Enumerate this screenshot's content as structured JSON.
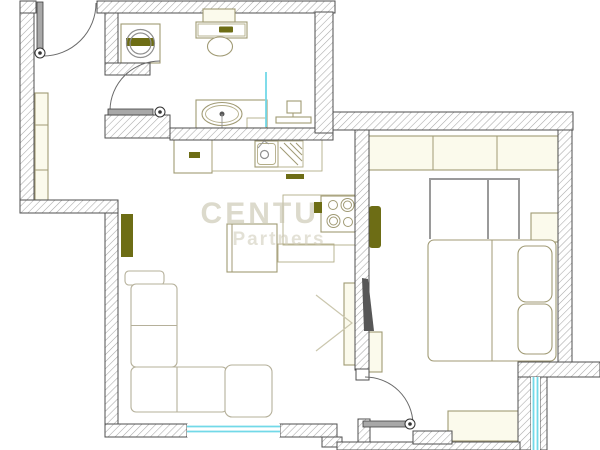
{
  "watermark": {
    "line1": "CENTURY",
    "line2": "Partners"
  },
  "canvas": {
    "width": 600,
    "height": 450,
    "background": "#ffffff"
  },
  "plan": {
    "wall_stroke": "#4f4f4f",
    "hatch_line": "#a8a8a8",
    "styles": {
      "tan": {
        "stroke": "#a09a74",
        "fill": "#ffffff",
        "sw": 1.1
      },
      "tanthin": {
        "stroke": "#b3ad88",
        "fill": "none",
        "sw": 0.9
      },
      "cream": {
        "stroke": "#a09a74",
        "fill": "#fbfaec",
        "sw": 1.1
      },
      "olive": {
        "stroke": "none",
        "fill": "#6d6d15",
        "sw": 0
      },
      "tanline": {
        "stroke": "#a09a74",
        "fill": "none",
        "sw": 1
      },
      "chevron": {
        "stroke": "#cbc7ae",
        "fill": "none",
        "sw": 1.2
      },
      "gray": {
        "stroke": "#8f8f8f",
        "fill": "none",
        "sw": 1.2
      },
      "gray2": {
        "stroke": "#9a9a9a",
        "fill": "none",
        "sw": 2
      },
      "grayline": {
        "stroke": "#999999",
        "fill": "none",
        "sw": 1
      },
      "sofa": {
        "stroke": "#b5b09a",
        "fill": "#ffffff",
        "sw": 1.1
      },
      "cyan": {
        "stroke": "#72d9e8",
        "fill": "none",
        "sw": 1.8
      },
      "dark": {
        "stroke": "none",
        "fill": "#575757",
        "sw": 0
      },
      "white": {
        "stroke": "#4f4f4f",
        "fill": "#ffffff",
        "sw": 1
      },
      "door": {
        "stroke": "#3e3e3e",
        "fill": "#a8a8a8",
        "sw": 0.8
      },
      "arc": {
        "stroke": "#6a6a6a",
        "fill": "none",
        "sw": 1
      }
    },
    "walls": [
      {
        "n": "wall-left-outer",
        "x": 20,
        "y": 1,
        "w": 14,
        "h": 205
      },
      {
        "n": "wall-top-left-corner",
        "x": 20,
        "y": 1,
        "w": 16,
        "h": 12
      },
      {
        "n": "wall-top-bathroom",
        "x": 97,
        "y": 1,
        "w": 238,
        "h": 12
      },
      {
        "n": "wall-hall-bath-divider",
        "x": 105,
        "y": 13,
        "w": 13,
        "h": 54
      },
      {
        "n": "wall-divider-foot",
        "x": 105,
        "y": 63,
        "w": 45,
        "h": 12
      },
      {
        "n": "wall-bath-south-left",
        "x": 105,
        "y": 115,
        "w": 65,
        "h": 23
      },
      {
        "n": "wall-bath-south-right",
        "x": 170,
        "y": 128,
        "w": 163,
        "h": 12
      },
      {
        "n": "wall-bath-east",
        "x": 315,
        "y": 12,
        "w": 18,
        "h": 121
      },
      {
        "n": "wall-bedroom-north",
        "x": 333,
        "y": 112,
        "w": 240,
        "h": 18
      },
      {
        "n": "wall-bedroom-west",
        "x": 355,
        "y": 130,
        "w": 14,
        "h": 240
      },
      {
        "n": "wall-bedroom-east",
        "x": 558,
        "y": 130,
        "w": 14,
        "h": 235
      },
      {
        "n": "wall-bedroom-se",
        "x": 518,
        "y": 362,
        "w": 82,
        "h": 15
      },
      {
        "n": "wall-balcony-left-strip",
        "x": 518,
        "y": 377,
        "w": 13,
        "h": 73
      },
      {
        "n": "wall-balcony-right-strip",
        "x": 540,
        "y": 377,
        "w": 7,
        "h": 73
      },
      {
        "n": "wall-jog-horizontal",
        "x": 20,
        "y": 200,
        "w": 98,
        "h": 13
      },
      {
        "n": "wall-living-west",
        "x": 105,
        "y": 213,
        "w": 13,
        "h": 224
      },
      {
        "n": "wall-living-south-a",
        "x": 105,
        "y": 424,
        "w": 82,
        "h": 13
      },
      {
        "n": "wall-living-south-b",
        "x": 280,
        "y": 424,
        "w": 57,
        "h": 13
      },
      {
        "n": "wall-jog-step",
        "x": 322,
        "y": 437,
        "w": 20,
        "h": 10
      },
      {
        "n": "wall-doorway-strip",
        "x": 358,
        "y": 419,
        "w": 12,
        "h": 31
      },
      {
        "n": "wall-bottom-band",
        "x": 337,
        "y": 442,
        "w": 183,
        "h": 8
      },
      {
        "n": "wall-bottom-right",
        "x": 413,
        "y": 431,
        "w": 39,
        "h": 13
      }
    ],
    "floor": [
      {
        "n": "hall-wardrobe",
        "k": "rect",
        "st": "cream",
        "x": 35,
        "y": 93,
        "w": 13,
        "h": 107
      },
      {
        "n": "hall-wardrobe-shelf",
        "k": "line",
        "st": "tanline",
        "x1": 35,
        "y1": 125,
        "x2": 48,
        "y2": 125
      },
      {
        "n": "hall-wardrobe-shelf",
        "k": "line",
        "st": "tanline",
        "x1": 35,
        "y1": 170,
        "x2": 48,
        "y2": 170
      },
      {
        "n": "washing-machine-body",
        "k": "rect",
        "st": "tan",
        "x": 121,
        "y": 24,
        "w": 39,
        "h": 39
      },
      {
        "n": "washing-machine-band",
        "k": "rect",
        "st": "olive",
        "x": 126,
        "y": 38,
        "w": 28,
        "h": 8
      },
      {
        "n": "washing-machine-drum",
        "k": "circle",
        "st": "gray",
        "cx": 140.5,
        "cy": 43.5,
        "r": 14
      },
      {
        "n": "washing-machine-drum-inner",
        "k": "circle",
        "st": "gray",
        "cx": 140.5,
        "cy": 43.5,
        "r": 10.5
      },
      {
        "n": "toilet-tank",
        "k": "rect",
        "st": "tan",
        "x": 196,
        "y": 22,
        "w": 51,
        "h": 16
      },
      {
        "n": "toilet-tank-inner",
        "k": "rect",
        "st": "tanthin",
        "x": 198,
        "y": 24,
        "w": 47,
        "h": 12
      },
      {
        "n": "toilet-flush-button",
        "k": "rect",
        "st": "olive",
        "x": 219,
        "y": 26.5,
        "w": 14,
        "h": 6,
        "rx": 1
      },
      {
        "n": "toilet-bowl",
        "k": "ellipse",
        "st": "tan",
        "cx": 220,
        "cy": 46.5,
        "rx": 12.5,
        "ry": 9.5
      },
      {
        "n": "bath-vanity",
        "k": "rect",
        "st": "tan",
        "x": 196,
        "y": 100,
        "w": 71,
        "h": 28
      },
      {
        "n": "bath-basin",
        "k": "ellipse",
        "st": "tan",
        "cx": 222,
        "cy": 114,
        "rx": 20,
        "ry": 11.5
      },
      {
        "n": "bath-basin-inner",
        "k": "ellipse",
        "st": "tanthin",
        "cx": 222,
        "cy": 114,
        "rx": 16.5,
        "ry": 8.5
      },
      {
        "n": "bath-faucet",
        "k": "circle",
        "st": "dark",
        "cx": 222,
        "cy": 114,
        "r": 2.5
      },
      {
        "n": "bath-faucet-stem",
        "k": "line",
        "st": "grayline",
        "x1": 222,
        "y1": 114,
        "x2": 222,
        "y2": 129
      },
      {
        "n": "bath-vanity-step",
        "k": "rect",
        "st": "tanthin",
        "x": 247,
        "y": 118,
        "w": 19,
        "h": 10
      },
      {
        "n": "towel-radiator-box",
        "k": "rect",
        "st": "tan",
        "x": 287,
        "y": 101,
        "w": 14,
        "h": 12
      },
      {
        "n": "towel-radiator-base",
        "k": "rect",
        "st": "tan",
        "x": 276,
        "y": 117,
        "w": 35,
        "h": 6
      },
      {
        "n": "towel-radiator-stem",
        "k": "line",
        "st": "tanline",
        "x1": 293,
        "y1": 113,
        "x2": 293,
        "y2": 117
      },
      {
        "n": "bath-partition",
        "k": "line",
        "st": "cyan",
        "x1": 266,
        "y1": 72,
        "x2": 266,
        "y2": 127
      },
      {
        "n": "fridge",
        "k": "rect",
        "st": "tan",
        "x": 174,
        "y": 137,
        "w": 38,
        "h": 36
      },
      {
        "n": "fridge-handle",
        "k": "rect",
        "st": "olive",
        "x": 189,
        "y": 152,
        "w": 11,
        "h": 6
      },
      {
        "n": "kitchen-counter",
        "k": "rect",
        "st": "tanthin",
        "x": 212,
        "y": 138,
        "w": 110,
        "h": 33
      },
      {
        "n": "kitchen-sink",
        "k": "rect",
        "st": "tan",
        "x": 255,
        "y": 141,
        "w": 23,
        "h": 26
      },
      {
        "n": "kitchen-sink-inner",
        "k": "rect",
        "st": "tanthin",
        "x": 257.5,
        "y": 143.5,
        "w": 18,
        "h": 21,
        "rx": 3
      },
      {
        "n": "kitchen-sink-drain",
        "k": "circle",
        "st": "gray",
        "cx": 264.5,
        "cy": 154.5,
        "r": 4
      },
      {
        "n": "kitchen-faucet",
        "k": "path",
        "st": "grayline",
        "d": "M258,148 L264,141 L269,144"
      },
      {
        "n": "kitchen-drainer",
        "k": "rect",
        "st": "tanthin",
        "x": 278,
        "y": 141,
        "w": 25,
        "h": 26
      },
      {
        "n": "kitchen-drainer-lines",
        "k": "path",
        "st": "tanline",
        "d": "M280,147 L298,165 M284,143 L302,161 M290,143 L302,155 M296,143 L302,149"
      },
      {
        "n": "kitchen-cabinet-handle",
        "k": "rect",
        "st": "olive",
        "x": 286,
        "y": 174,
        "w": 18,
        "h": 5
      },
      {
        "n": "stove-counter",
        "k": "rect",
        "st": "tanthin",
        "x": 283,
        "y": 195,
        "w": 73,
        "h": 50
      },
      {
        "n": "kitchen-table",
        "k": "rect",
        "st": "tan",
        "x": 227,
        "y": 224,
        "w": 50,
        "h": 48
      },
      {
        "n": "kitchen-table-edge",
        "k": "line",
        "st": "tanline",
        "x1": 232,
        "y1": 224,
        "x2": 232,
        "y2": 272
      },
      {
        "n": "kitchen-bench",
        "k": "rect",
        "st": "tanthin",
        "x": 278,
        "y": 244,
        "w": 56,
        "h": 18
      },
      {
        "n": "living-radiator",
        "k": "rect",
        "st": "olive",
        "x": 121,
        "y": 214,
        "w": 12,
        "h": 43
      },
      {
        "n": "sofa-armrest",
        "k": "rect",
        "st": "sofa",
        "x": 125,
        "y": 271,
        "w": 39,
        "h": 14,
        "rx": 4
      },
      {
        "n": "sofa-back",
        "k": "rect",
        "st": "sofa",
        "x": 131,
        "y": 284,
        "w": 46,
        "h": 83,
        "rx": 5
      },
      {
        "n": "sofa-back-divider",
        "k": "line",
        "st": "sofa",
        "x1": 131,
        "y1": 325.5,
        "x2": 177,
        "y2": 325.5
      },
      {
        "n": "sofa-seats",
        "k": "rect",
        "st": "sofa",
        "x": 131,
        "y": 367,
        "w": 96,
        "h": 45,
        "rx": 5
      },
      {
        "n": "sofa-seat-divider",
        "k": "line",
        "st": "sofa",
        "x1": 177,
        "y1": 367,
        "x2": 177,
        "y2": 412
      },
      {
        "n": "sofa-chaise",
        "k": "rect",
        "st": "sofa",
        "x": 225,
        "y": 365,
        "w": 47,
        "h": 52,
        "rx": 7
      },
      {
        "n": "tv-board",
        "k": "rect",
        "st": "cream",
        "x": 344,
        "y": 283,
        "w": 14,
        "h": 82
      },
      {
        "n": "tv-direction-chevron",
        "k": "path",
        "st": "chevron",
        "d": "M316,295 L352,323 L316,351"
      },
      {
        "n": "bedroom-wardrobe",
        "k": "rect",
        "st": "cream",
        "x": 368,
        "y": 136,
        "w": 190,
        "h": 34
      },
      {
        "n": "bedroom-wardrobe-divider",
        "k": "line",
        "st": "tanline",
        "x1": 433,
        "y1": 136,
        "x2": 433,
        "y2": 170
      },
      {
        "n": "bedroom-wardrobe-divider",
        "k": "line",
        "st": "tanline",
        "x1": 497,
        "y1": 136,
        "x2": 497,
        "y2": 170
      },
      {
        "n": "bed-headboard",
        "k": "path",
        "st": "gray2",
        "d": "M430,239 L430,179 L519,179 L519,239 M488,179 L488,239"
      },
      {
        "n": "nightstand",
        "k": "rect",
        "st": "cream",
        "x": 531,
        "y": 213,
        "w": 28,
        "h": 29
      },
      {
        "n": "bedroom-radiator",
        "k": "rect",
        "st": "olive",
        "x": 369,
        "y": 206,
        "w": 12,
        "h": 42,
        "rx": 3
      },
      {
        "n": "bed",
        "k": "rect",
        "st": "tan",
        "x": 428,
        "y": 240,
        "w": 128,
        "h": 121,
        "rx": 6
      },
      {
        "n": "bed-divider",
        "k": "line",
        "st": "tanline",
        "x1": 492,
        "y1": 240,
        "x2": 492,
        "y2": 361
      },
      {
        "n": "pillow-top",
        "k": "rect",
        "st": "tan",
        "x": 518,
        "y": 246,
        "w": 34,
        "h": 56,
        "rx": 8
      },
      {
        "n": "pillow-bottom",
        "k": "rect",
        "st": "tan",
        "x": 518,
        "y": 304,
        "w": 34,
        "h": 50,
        "rx": 8
      },
      {
        "n": "bedroom-shelf",
        "k": "rect",
        "st": "cream",
        "x": 368,
        "y": 332,
        "w": 14,
        "h": 40
      },
      {
        "n": "bedroom-bench",
        "k": "rect",
        "st": "cream",
        "x": 448,
        "y": 411,
        "w": 71,
        "h": 30
      }
    ],
    "stove": [
      {
        "n": "stove-body",
        "k": "rect",
        "st": "tan",
        "x": 321,
        "y": 196,
        "w": 35,
        "h": 36
      },
      {
        "n": "stove-knob",
        "k": "rect",
        "st": "olive",
        "x": 314,
        "y": 202,
        "w": 8,
        "h": 11
      },
      {
        "n": "burner",
        "k": "circle",
        "st": "tanline",
        "cx": 333,
        "cy": 205,
        "r": 4.5
      },
      {
        "n": "burner",
        "k": "circle",
        "st": "tanline",
        "cx": 347.5,
        "cy": 205,
        "r": 6.5
      },
      {
        "n": "burner",
        "k": "circle",
        "st": "tanline",
        "cx": 347.5,
        "cy": 205,
        "r": 4
      },
      {
        "n": "burner",
        "k": "circle",
        "st": "tanline",
        "cx": 333.5,
        "cy": 221,
        "r": 6.5
      },
      {
        "n": "burner",
        "k": "circle",
        "st": "tanline",
        "cx": 333.5,
        "cy": 221,
        "r": 4
      },
      {
        "n": "burner",
        "k": "circle",
        "st": "tanline",
        "cx": 348,
        "cy": 222,
        "r": 4.5
      }
    ],
    "openings": [
      {
        "n": "wall-end-cap",
        "k": "rect",
        "st": "white",
        "x": 356,
        "y": 369,
        "w": 13,
        "h": 11
      },
      {
        "n": "bath-niche",
        "k": "rect",
        "st": "cream",
        "x": 203,
        "y": 9,
        "w": 32,
        "h": 13
      },
      {
        "n": "window-living",
        "k": "rect",
        "st": "whitefill",
        "x": 187,
        "y": 424,
        "w": 93,
        "h": 13
      },
      {
        "n": "window-living-glass",
        "k": "line",
        "st": "cyan",
        "x1": 187,
        "y1": 426.5,
        "x2": 280,
        "y2": 426.5
      },
      {
        "n": "window-living-glass",
        "k": "line",
        "st": "cyan",
        "x1": 187,
        "y1": 431.5,
        "x2": 280,
        "y2": 431.5
      },
      {
        "n": "window-balcony",
        "k": "rect",
        "st": "whitefill",
        "x": 531,
        "y": 377,
        "w": 9,
        "h": 73
      },
      {
        "n": "window-balcony-glass",
        "k": "line",
        "st": "cyan",
        "x1": 533.5,
        "y1": 377,
        "x2": 533.5,
        "y2": 450
      },
      {
        "n": "window-balcony-glass",
        "k": "line",
        "st": "cyan",
        "x1": 537.5,
        "y1": 377,
        "x2": 537.5,
        "y2": 450
      },
      {
        "n": "entry-door-arc",
        "k": "path",
        "st": "arc",
        "d": "M43,56 A53,53 0 0 0 96,3"
      },
      {
        "n": "entry-door-leaf",
        "k": "rect",
        "st": "door",
        "x": 37,
        "y": 2,
        "w": 6,
        "h": 54
      },
      {
        "n": "bath-door-arc",
        "k": "path",
        "st": "arc",
        "d": "M110,110 A50,50 0 0 1 160,61"
      },
      {
        "n": "bath-door-leaf",
        "k": "rect",
        "st": "door",
        "x": 108,
        "y": 109,
        "w": 45,
        "h": 6
      },
      {
        "n": "bedroom-door-arc",
        "k": "path",
        "st": "arc",
        "d": "M413,424 A48,48 0 0 0 365,377"
      },
      {
        "n": "bedroom-door-leaf",
        "k": "rect",
        "st": "door",
        "x": 363,
        "y": 421,
        "w": 45,
        "h": 6
      }
    ],
    "hinges": [
      {
        "n": "entry-door-hinge",
        "cx": 40,
        "cy": 53
      },
      {
        "n": "bath-door-hinge",
        "cx": 160,
        "cy": 112
      },
      {
        "n": "bedroom-door-hinge",
        "cx": 410,
        "cy": 424
      }
    ],
    "overlay": [
      {
        "n": "tv-screen",
        "k": "poly",
        "st": "dark",
        "pts": "362,278 368,279 374,331 364,331"
      }
    ]
  }
}
